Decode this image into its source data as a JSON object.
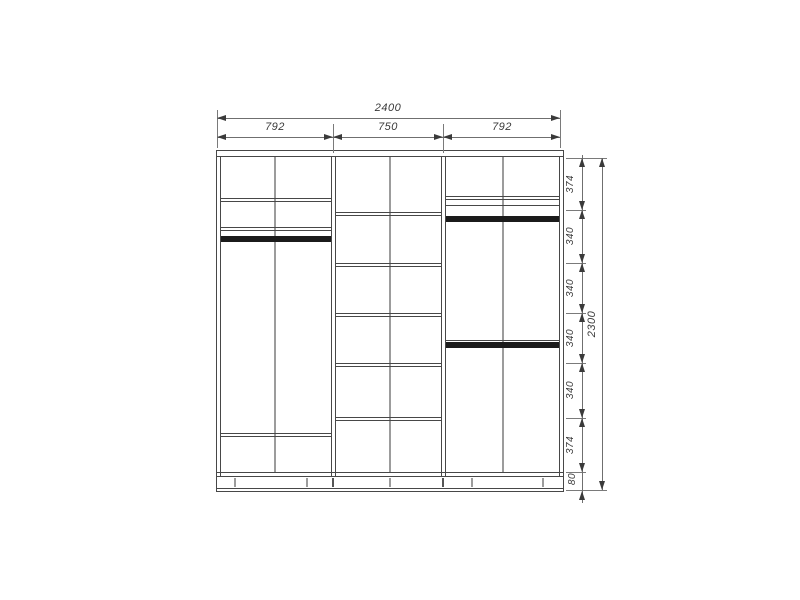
{
  "drawing": {
    "total_width_mm": "2400",
    "section_widths_mm": [
      "792",
      "750",
      "792"
    ],
    "total_height_mm": "2300",
    "height_segments_mm": [
      "374",
      "340",
      "340",
      "340",
      "340",
      "374",
      "80"
    ]
  }
}
